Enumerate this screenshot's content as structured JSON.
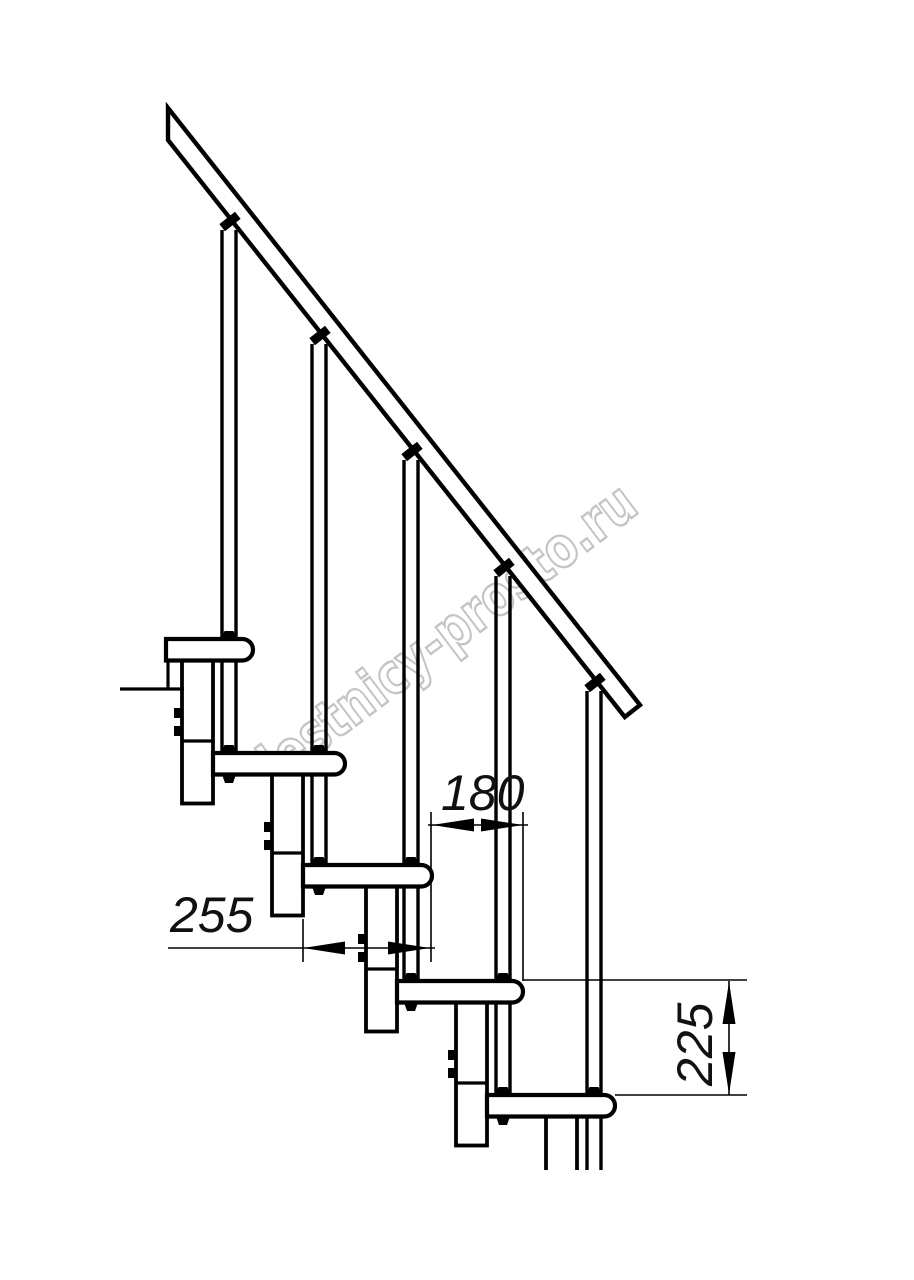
{
  "page": {
    "background_color": "#ffffff",
    "line_color": "#000000"
  },
  "watermark": {
    "text": "lestnicy-prosto.ru",
    "outline_color": "#c4c4c4"
  },
  "dimensions": {
    "tread_depth": {
      "value": "255"
    },
    "tread_overlap": {
      "value": "180"
    },
    "step_height": {
      "value": "225"
    }
  }
}
